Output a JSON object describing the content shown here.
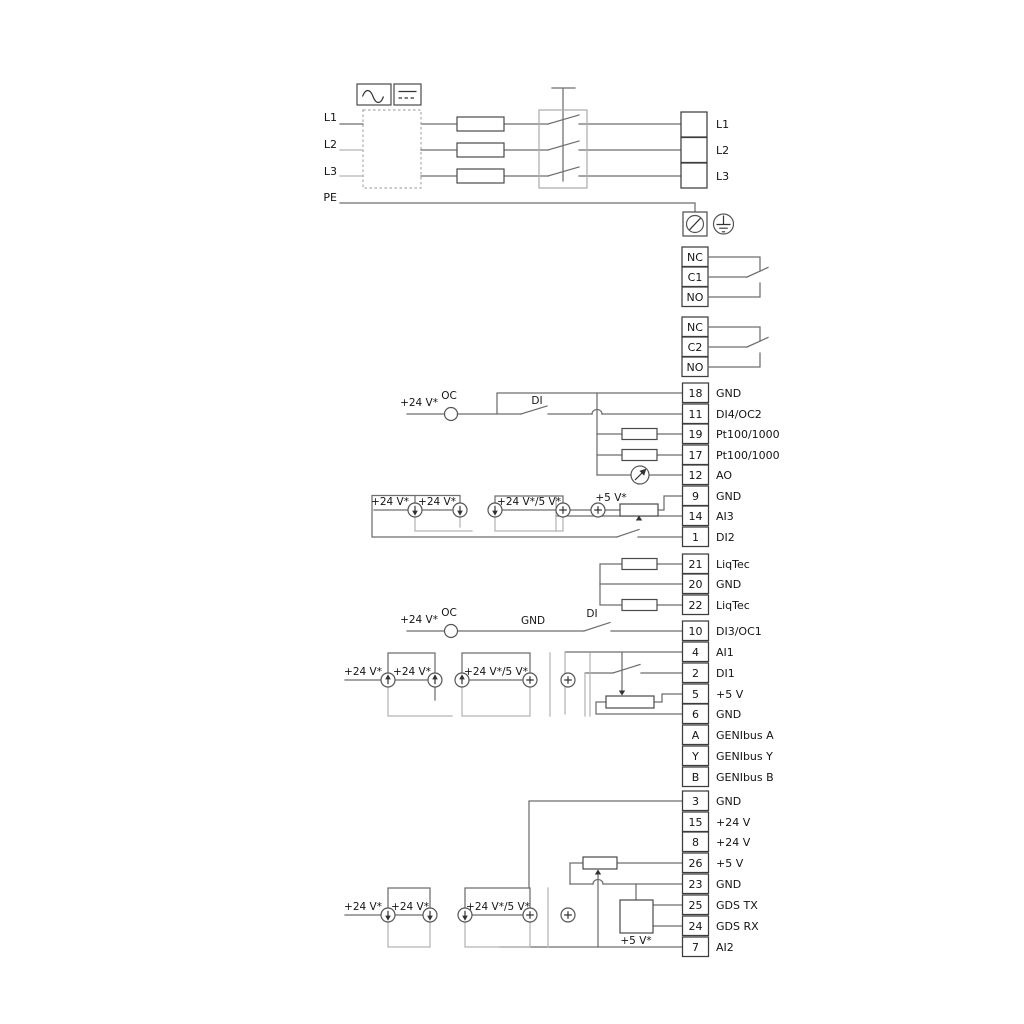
{
  "power": {
    "left": [
      "L1",
      "L2",
      "L3",
      "PE"
    ],
    "right": [
      "L1",
      "L2",
      "L3"
    ]
  },
  "relays": {
    "r1": [
      "NC",
      "C1",
      "NO"
    ],
    "r2": [
      "NC",
      "C2",
      "NO"
    ]
  },
  "strip1": {
    "rows": [
      {
        "n": "18",
        "l": "GND"
      },
      {
        "n": "11",
        "l": "DI4/OC2"
      },
      {
        "n": "19",
        "l": "Pt100/1000"
      },
      {
        "n": "17",
        "l": "Pt100/1000"
      },
      {
        "n": "12",
        "l": "AO"
      },
      {
        "n": "9",
        "l": "GND"
      },
      {
        "n": "14",
        "l": "AI3"
      },
      {
        "n": "1",
        "l": "DI2"
      }
    ]
  },
  "liqtec": {
    "rows": [
      {
        "n": "21",
        "l": "LiqTec"
      },
      {
        "n": "20",
        "l": "GND"
      },
      {
        "n": "22",
        "l": "LiqTec"
      }
    ]
  },
  "strip2": {
    "rows": [
      {
        "n": "10",
        "l": "DI3/OC1"
      },
      {
        "n": "4",
        "l": "AI1"
      },
      {
        "n": "2",
        "l": "DI1"
      },
      {
        "n": "5",
        "l": "+5 V"
      },
      {
        "n": "6",
        "l": "GND"
      },
      {
        "n": "A",
        "l": "GENIbus A"
      },
      {
        "n": "Y",
        "l": "GENIbus Y"
      },
      {
        "n": "B",
        "l": "GENIbus B"
      }
    ]
  },
  "strip3": {
    "rows": [
      {
        "n": "3",
        "l": "GND"
      },
      {
        "n": "15",
        "l": "+24 V"
      },
      {
        "n": "8",
        "l": "+24 V"
      },
      {
        "n": "26",
        "l": "+5 V"
      },
      {
        "n": "23",
        "l": "GND"
      },
      {
        "n": "25",
        "l": "GDS TX"
      },
      {
        "n": "24",
        "l": "GDS RX"
      },
      {
        "n": "7",
        "l": "AI2"
      }
    ]
  },
  "sym": {
    "v24": "+24 V*",
    "v24_5": "+24 V*/5 V*",
    "v5": "+5 V*",
    "oc": "OC",
    "di": "DI",
    "gnd": "GND"
  },
  "colors": {
    "wire": "#6e6e6e",
    "wire_light": "#b3b3b3",
    "outline": "#4a4a4a",
    "text": "#141414",
    "background": "#ffffff"
  }
}
